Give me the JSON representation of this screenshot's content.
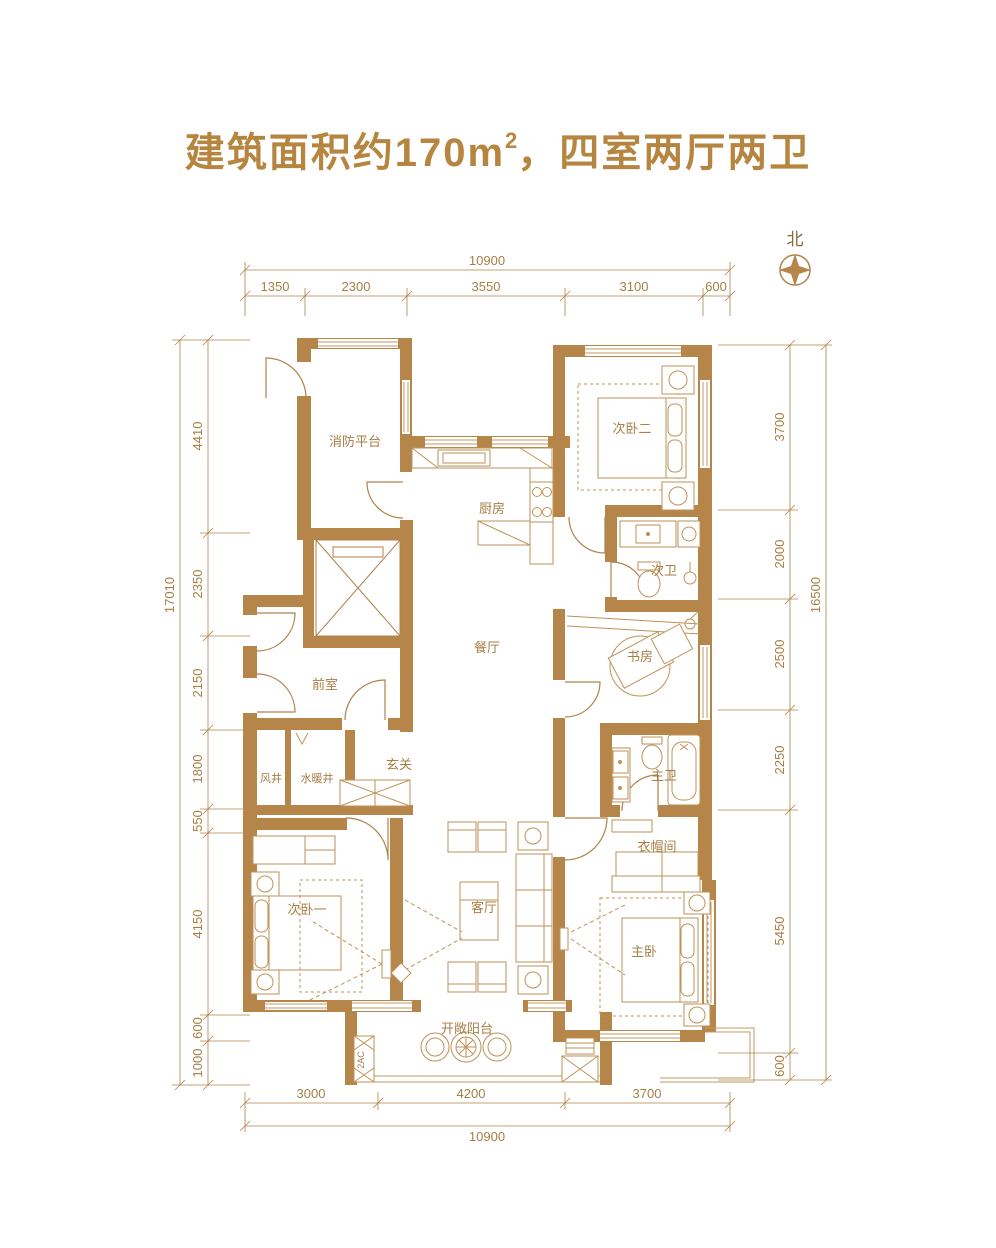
{
  "title": {
    "prefix": "建筑面积约170",
    "unit": "m",
    "power": "2",
    "suffix": "，四室两厅两卫"
  },
  "compass": {
    "north_label": "北"
  },
  "rooms": {
    "fire_platform": "消防平台",
    "kitchen": "厨房",
    "bedroom2": "次卧二",
    "bath2": "次卫",
    "dining": "餐厅",
    "study": "书房",
    "front_room": "前室",
    "entry": "玄关",
    "wind_shaft": "风井",
    "plumbing_shaft": "水暖井",
    "master_bath": "主卫",
    "cloakroom": "衣帽间",
    "bedroom1": "次卧一",
    "living": "客厅",
    "master_bedroom": "主卧",
    "balcony": "开敞阳台",
    "ac_shaft": "2AC"
  },
  "dims": {
    "top": {
      "total": "10900",
      "segments": [
        "1350",
        "2300",
        "3550",
        "3100",
        "600"
      ]
    },
    "bottom": {
      "total": "10900",
      "segments": [
        "3000",
        "4200",
        "3700"
      ]
    },
    "left": {
      "total": "17010",
      "segments": [
        "4410",
        "2350",
        "2150",
        "1800",
        "550",
        "4150",
        "600",
        "1000"
      ]
    },
    "right": {
      "total": "16500",
      "segments": [
        "3700",
        "2000",
        "2500",
        "2250",
        "5450",
        "600"
      ]
    }
  },
  "colors": {
    "wall": "#b6854a",
    "line": "#b0824a",
    "light_line": "#c49a63",
    "title": "#b6853f",
    "background": "#ffffff"
  }
}
